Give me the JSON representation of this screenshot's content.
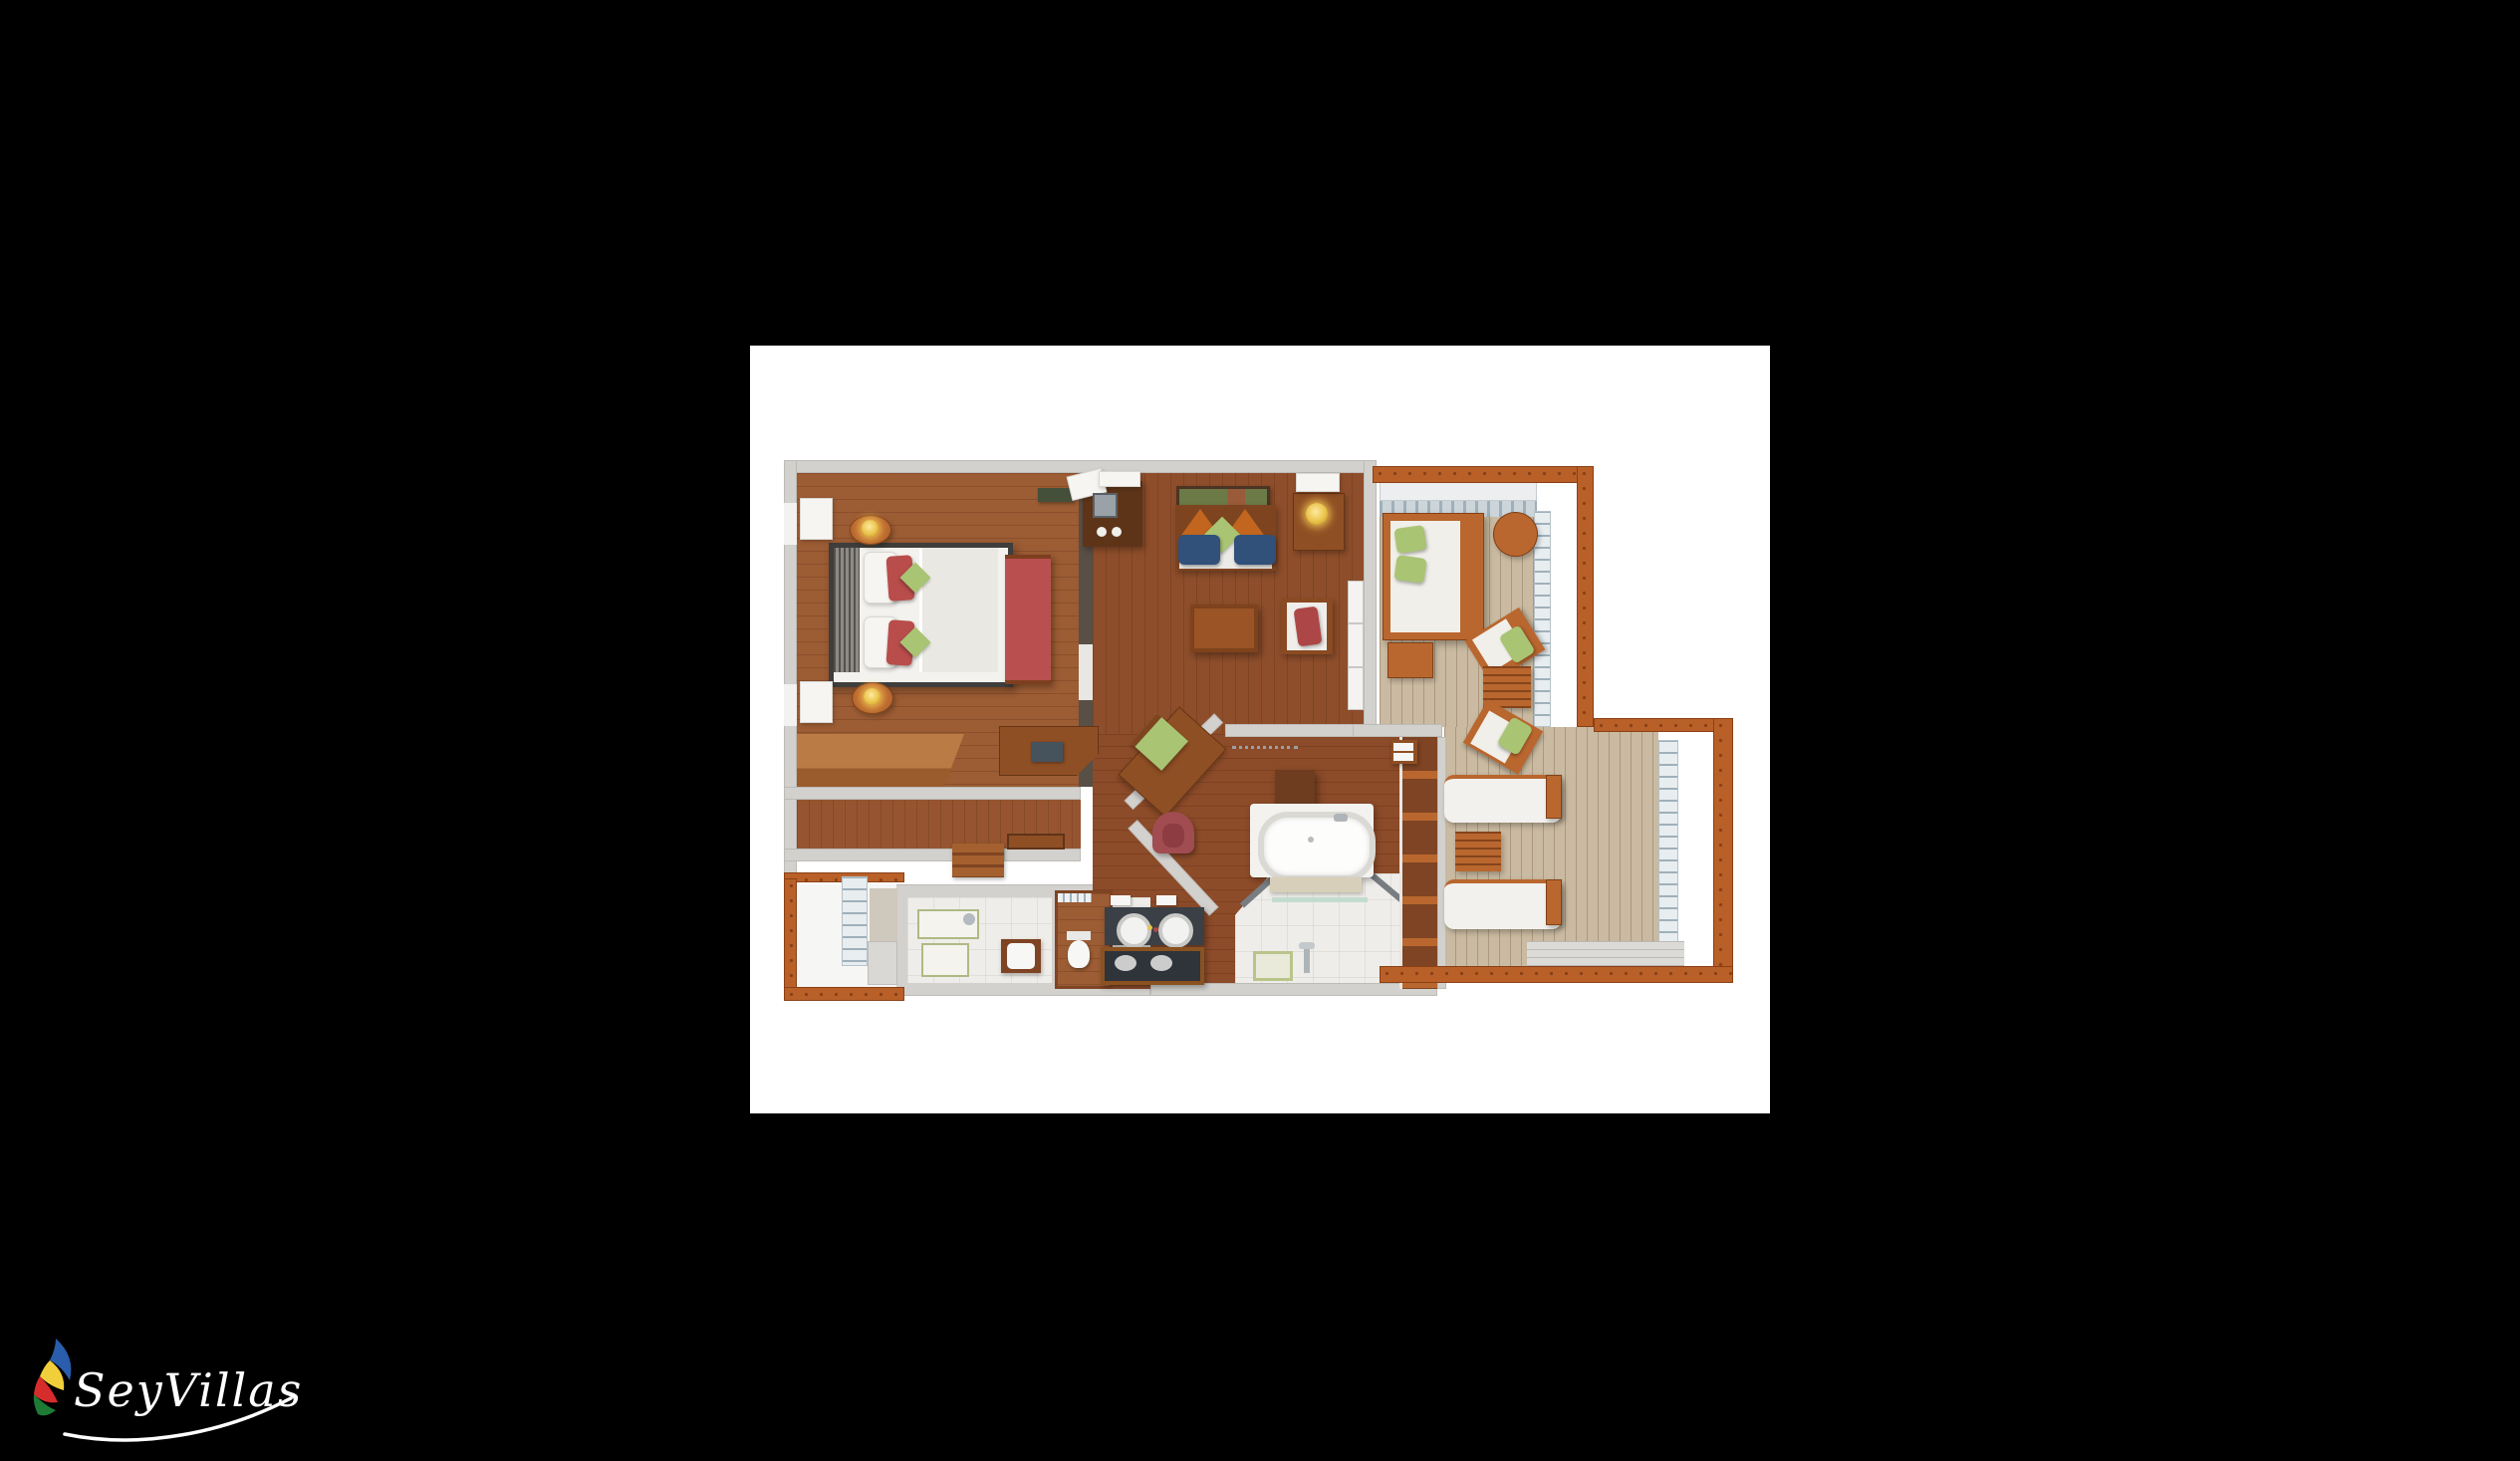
{
  "scene": {
    "background": "#000000",
    "canvas_color": "#ffffff",
    "description": "3D top-down rendered floor plan of a one-bedroom villa suite with veranda"
  },
  "logo": {
    "text": "SeyVillas",
    "color": "#ffffff",
    "flame_colors": {
      "blue": "#2a5dab",
      "yellow": "#f1cf3a",
      "red": "#d62c2c",
      "green": "#1d7b35"
    }
  },
  "floorplan": {
    "palette": {
      "wall": "#d3d1ce",
      "wood_living": "#8e4e2b",
      "wood_bedroom": "#9c5c34",
      "deck_wood": "#cabaa1",
      "frame_orange": "#b96029",
      "railing": "#e8edf0",
      "tile": "#efede9",
      "vanity_counter": "#3a4046",
      "accent_red": "#b84d4b",
      "accent_green": "#a9c473",
      "accent_blue": "#31507a",
      "accent_orange": "#c2661f",
      "lamp_gold": "#e9c34a"
    },
    "rooms": [
      {
        "id": "bedroom",
        "contents": [
          "four-poster double bed",
          "red bed bench",
          "two nightstands with gold lamps",
          "dresser",
          "writing desk",
          "window curtains"
        ]
      },
      {
        "id": "living-room",
        "contents": [
          "sofa with orange, green and blue cushions",
          "wall art",
          "minibar kitchenette",
          "coffee table",
          "armchair with red pillow",
          "side cabinet with gold lamp",
          "white wardrobe",
          "angled desk with green chair"
        ]
      },
      {
        "id": "dressing-corridor",
        "contents": [
          "steps",
          "bench with tray",
          "hanging rail"
        ]
      },
      {
        "id": "bathroom",
        "contents": [
          "oval bathtub on white platform",
          "privacy partition",
          "towel bench",
          "glass shelf",
          "shower fixture",
          "double vanity with round basins",
          "framed mirror tray",
          "red curved chair",
          "louvre shelf wall",
          "towel rack"
        ]
      },
      {
        "id": "wc",
        "contents": [
          "toilet",
          "bath mats",
          "tap"
        ]
      },
      {
        "id": "outdoor-shower-room",
        "contents": [
          "toilet",
          "louvre window"
        ]
      },
      {
        "id": "entrance-porch",
        "contents": [
          "orange timber frame",
          "railing",
          "step"
        ]
      },
      {
        "id": "veranda",
        "contents": [
          "pergola slats",
          "daybed with green pillows",
          "side table",
          "round table",
          "two angled lounge chairs",
          "slatted tables",
          "two sun loungers",
          "deck steps",
          "railings",
          "orange timber frame"
        ]
      }
    ]
  }
}
